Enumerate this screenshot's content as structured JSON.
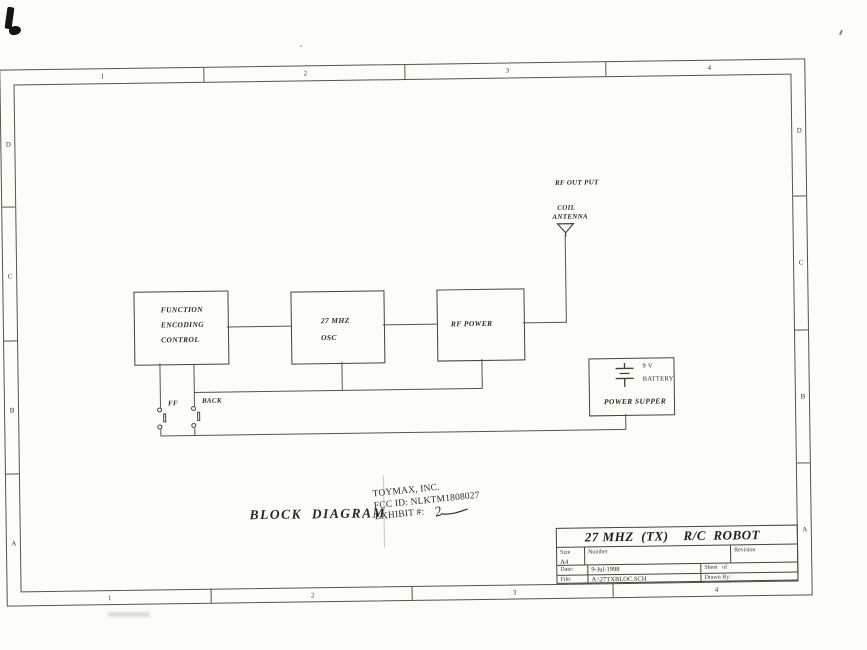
{
  "frame": {
    "zones_top": [
      "1",
      "2",
      "3",
      "4"
    ],
    "zones_bottom": [
      "1",
      "2",
      "3",
      "4"
    ],
    "zones_left": [
      "D",
      "C",
      "B",
      "A"
    ],
    "zones_right": [
      "D",
      "C",
      "B",
      "A"
    ]
  },
  "blocks": {
    "function": {
      "l1": "FUNCTION",
      "l2": "ENCODING",
      "l3": "CONTROL"
    },
    "osc": {
      "l1": "27 MHZ",
      "l2": "OSC"
    },
    "rf": {
      "label": "RF POWER"
    },
    "power": {
      "voltage": "9 V",
      "battery": "BATTERY",
      "label": "POWER SUPPER"
    }
  },
  "signals": {
    "rf_output": "RF OUT PUT",
    "coil": "COIL",
    "antenna": "ANTENNA"
  },
  "switches": {
    "ff": "FF",
    "back": "BACK"
  },
  "caption": "BLOCK  DIAGRAM",
  "stamp": {
    "company": "TOYMAX, INC.",
    "fcc_id": "FCC ID: NLKTM1808027",
    "exhibit_label": "EXHIBIT #:",
    "exhibit_value": "2"
  },
  "titleblock": {
    "title": "27 MHZ  (TX)    R/C  ROBOT",
    "size_label": "Size",
    "size_value": "A4",
    "number_label": "Number",
    "revision_label": "Revision",
    "date_label": "Date:",
    "date_value": "9-Jul-1998",
    "file_label": "File:",
    "file_value": "A:\\27TXBLOC.SCH",
    "sheet_label": "Sheet   of",
    "drawn_label": "Drawn By:"
  }
}
